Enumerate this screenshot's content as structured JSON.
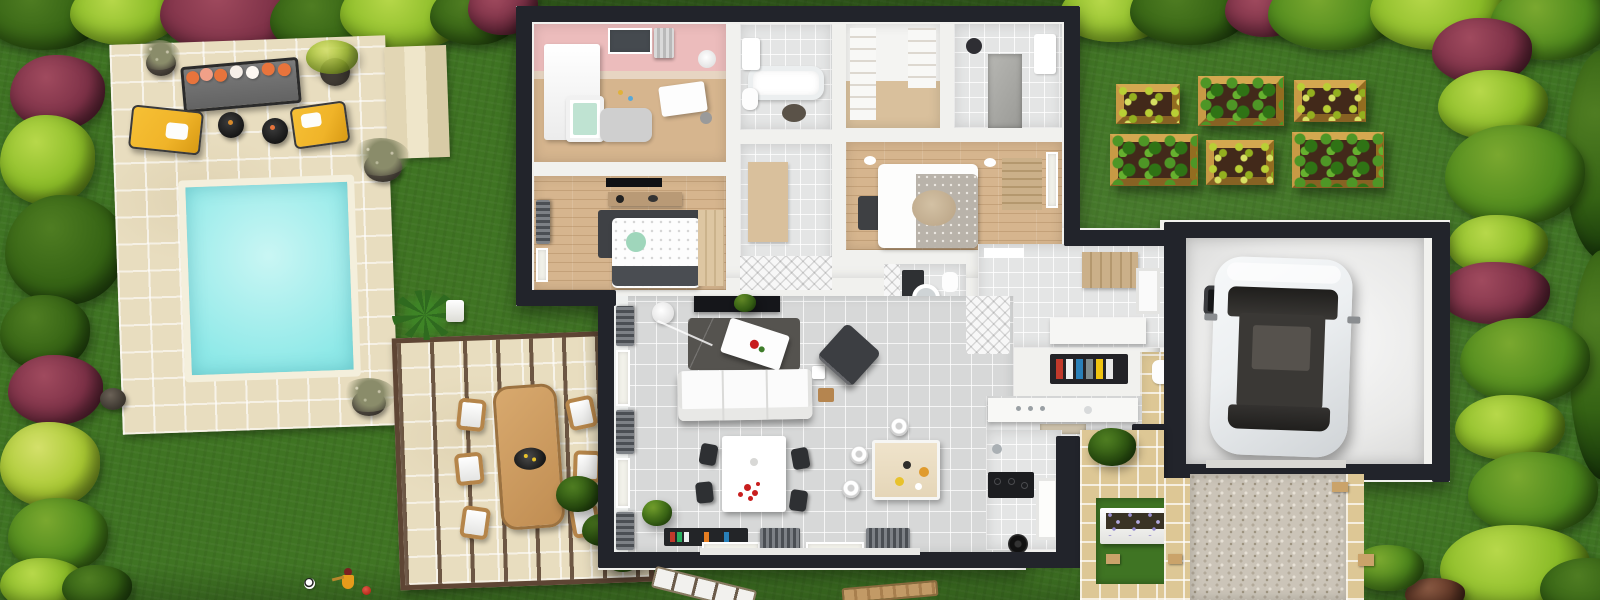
{
  "scene": {
    "type": "3d-floor-plan-render",
    "description": "Aerial 3D rendering of a single-storey house shown as an open-roof floor plan, surrounded by a landscaped garden with swimming pool, stone lounge patio, pergola dining terrace, raised vegetable planters, gravel driveway and an attached garage with a white car.",
    "canvas": {
      "width": 1600,
      "height": 600
    }
  },
  "colors": {
    "lawn": "#3f7423",
    "lawn-dark": "#2e5a16",
    "wall": "#22242b",
    "stone": "#e8ddbf",
    "pool": "#8fe9e8",
    "coping": "#f4efdc",
    "wood": "#d6b58e",
    "tilew": "#e4e5e5",
    "tileg": "#d7d8d8",
    "etile": "#ddc795",
    "gravel": "#cbc4b8",
    "soil": "#42291a",
    "pwood": "#b98b3c",
    "orange": "#e8743c",
    "yellow": "#f0b429",
    "car": "#eceff1",
    "glass": "#2e2d2b",
    "rug": "#4a4a4a",
    "cur": "#62666b",
    "pink": "#ecbcbc",
    "lav": "#9a8fd0",
    "red": "#c81e1e"
  },
  "labels": {
    "scene": "3D house floor plan with garden",
    "lawn": "Lawn",
    "hedge": "Garden hedge of green and burgundy shrubs",
    "patio": "Stone lounge patio",
    "outdoor_sofa": "Outdoor sofa with orange cushions",
    "lounge_chair_left": "Yellow lounge chair",
    "lounge_chair_right": "Yellow lounge chair",
    "fire_table": "Round black fire table",
    "pool_deck": "Stone pool deck",
    "pool": "Swimming pool",
    "pool_steps": "Patio steps",
    "pergola": "Pergola dining terrace",
    "outdoor_table": "Wooden outdoor dining table",
    "outdoor_chair": "Outdoor dining chair",
    "palm": "Palm plant",
    "house": "House floor plan",
    "nursery": "Nursery with pink walls",
    "bathroom_main": "Main bathroom with bathtub",
    "wardrobe_room": "Walk-in wardrobe",
    "shower_room": "Shower room",
    "hallway": "Hallway",
    "bedroom": "Bedroom",
    "master_bedroom": "Master bedroom",
    "vanity_bathroom": "Bathroom with vanity and round mirror",
    "storage_room": "Laundry and storage room",
    "dressing_nook": "Dressing nook with hanging clothes",
    "wc": "WC",
    "living_room": "Living room",
    "sofa": "White three-seat sofa",
    "coffee_table": "White coffee table on dark rug",
    "tv_console": "TV media console",
    "lounge_seat": "Charcoal lounge chair",
    "dining_table": "Dining table with red centerpiece",
    "kitchen": "Kitchen",
    "kitchen_island": "Kitchen island with stools",
    "cooktop": "Black cooktop",
    "entry_path": "Tiled entry path",
    "lavender_planter": "White planter with lavender",
    "garage": "Garage",
    "car": "White car parked in garage",
    "garage_door": "Garage door opening",
    "driveway": "Gravel driveway",
    "planters": "Raised vegetable planters",
    "toys": "Toys on the lawn",
    "soccer_ball": "Soccer ball",
    "doll": "Toy doll",
    "sun_lounger": "Sun lounger"
  },
  "garden": {
    "planter_grid": {
      "rows": 2,
      "cols": 3,
      "count": 6
    },
    "fire_table_count": 2,
    "lounge_chair_count": 2,
    "sun_lounger_count": 2
  }
}
